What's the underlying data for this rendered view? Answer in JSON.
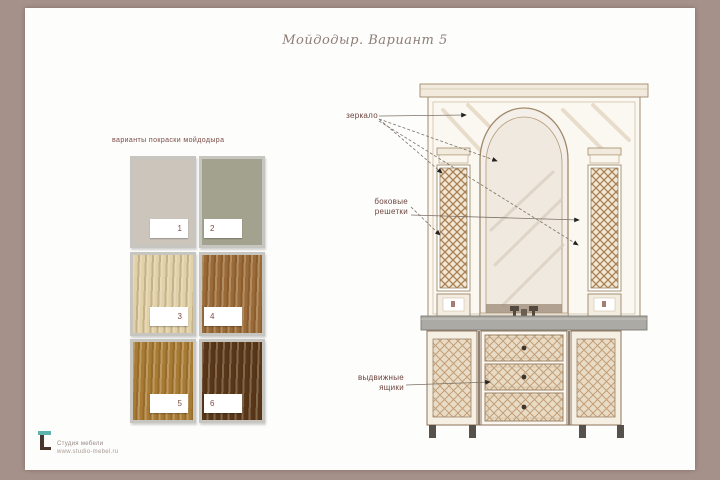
{
  "title": {
    "text": "Мойдодыр. Вариант 5"
  },
  "swatch_section": {
    "caption": "варианты покраски мойдодыра",
    "swatches": [
      {
        "num": "1",
        "color": "#cbc5bc"
      },
      {
        "num": "2",
        "color": "#a2a28e"
      },
      {
        "num": "3",
        "color": "#e1d1a8"
      },
      {
        "num": "4",
        "color": "#9a6a38"
      },
      {
        "num": "5",
        "color": "#a87b35"
      },
      {
        "num": "6",
        "color": "#573619"
      }
    ]
  },
  "annotations": {
    "mirror": "зеркало",
    "lattice": {
      "line1": "боковые",
      "line2": "решетки"
    },
    "drawers": {
      "line1": "выдвижные",
      "line2": "ящики"
    }
  },
  "footer": {
    "line1": "Студия мебели",
    "line2": "www.studio-mebel.ru"
  },
  "colors": {
    "frame_taupe": "#a5918a",
    "label_maroon": "#6d4540",
    "logo_teal": "#5fb3ab",
    "logo_brown": "#4a352c"
  }
}
